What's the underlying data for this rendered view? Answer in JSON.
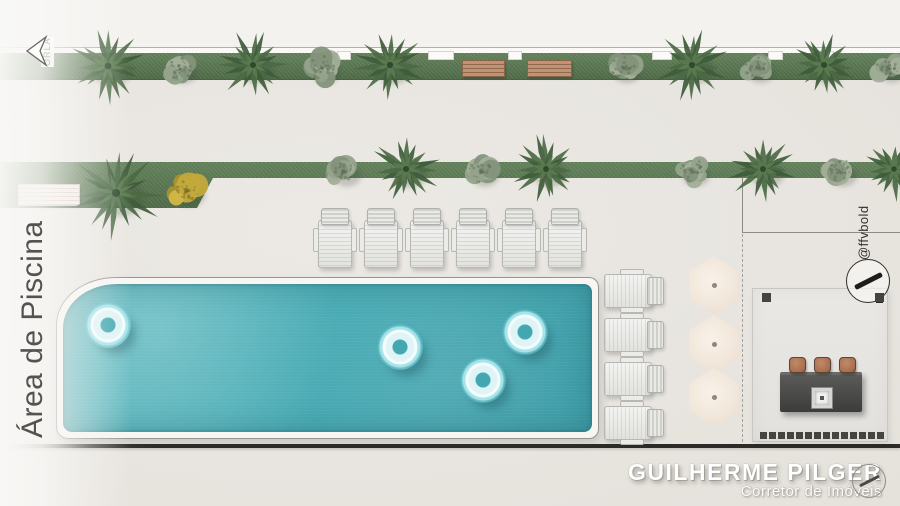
{
  "labels": {
    "area": "Área de Piscina",
    "orla": "ORLA",
    "handle": "@ffvbold",
    "brand_name": "GUILHERME PILGER",
    "brand_role": "Corretor de Imóveis"
  },
  "colors": {
    "grass": "#5e7f57",
    "water": "#49abb4",
    "coping": "#f7f6f3",
    "deck": "#e8e5e0",
    "wood_bench": "#bc8f6f",
    "dark_wall": "#2d2b28",
    "umbrella": "#f0e5d8",
    "counter": "#424240",
    "stool": "#b5795a"
  },
  "icons": {
    "orla_arrow": "left-arrow-icon",
    "logo": "slash-circle-icon"
  },
  "site": {
    "top_band": {
      "trees": [
        {
          "type": "palm",
          "x": 108,
          "y": 66,
          "s": 64
        },
        {
          "type": "bush",
          "x": 180,
          "y": 69,
          "s": 46
        },
        {
          "type": "palm",
          "x": 253,
          "y": 65,
          "s": 56
        },
        {
          "type": "bush",
          "x": 322,
          "y": 68,
          "s": 52
        },
        {
          "type": "palm",
          "x": 390,
          "y": 65,
          "s": 58
        },
        {
          "type": "bush",
          "x": 623,
          "y": 68,
          "s": 50
        },
        {
          "type": "palm",
          "x": 692,
          "y": 65,
          "s": 58
        },
        {
          "type": "bush",
          "x": 757,
          "y": 68,
          "s": 48
        },
        {
          "type": "palm",
          "x": 824,
          "y": 65,
          "s": 56
        },
        {
          "type": "bush",
          "x": 888,
          "y": 68,
          "s": 46
        }
      ],
      "benches": [
        {
          "x": 462,
          "y": 60,
          "w": 43
        },
        {
          "x": 527,
          "y": 60,
          "w": 45
        }
      ],
      "notches": [
        {
          "x": 337,
          "w": 14
        },
        {
          "x": 428,
          "w": 26
        },
        {
          "x": 508,
          "w": 14
        },
        {
          "x": 652,
          "w": 20
        },
        {
          "x": 768,
          "w": 15
        },
        {
          "x": 816,
          "w": 18
        }
      ]
    },
    "mid_band": {
      "trees": [
        {
          "type": "palm",
          "x": 116,
          "y": 193,
          "s": 80
        },
        {
          "type": "yellow",
          "x": 186,
          "y": 190,
          "s": 58
        },
        {
          "type": "bush",
          "x": 343,
          "y": 171,
          "s": 52
        },
        {
          "type": "palm",
          "x": 406,
          "y": 169,
          "s": 56
        },
        {
          "type": "bush",
          "x": 481,
          "y": 171,
          "s": 52
        },
        {
          "type": "palm",
          "x": 546,
          "y": 169,
          "s": 54
        },
        {
          "type": "bush",
          "x": 692,
          "y": 171,
          "s": 50
        },
        {
          "type": "palm",
          "x": 763,
          "y": 169,
          "s": 54
        },
        {
          "type": "bush",
          "x": 839,
          "y": 171,
          "s": 52
        },
        {
          "type": "palm",
          "x": 894,
          "y": 169,
          "s": 50
        }
      ]
    },
    "pool_floats": [
      {
        "cx": 108,
        "cy": 325
      },
      {
        "cx": 400,
        "cy": 347
      },
      {
        "cx": 483,
        "cy": 380
      },
      {
        "cx": 525,
        "cy": 332
      }
    ],
    "loungers_top": {
      "y": 208,
      "xs": [
        318,
        364,
        410,
        456,
        502,
        548
      ]
    },
    "loungers_right": {
      "x": 602,
      "ys": [
        274,
        318,
        362,
        406
      ]
    },
    "umbrellas": {
      "cx": 714,
      "cys": [
        285,
        344,
        397
      ]
    },
    "bbq_bottom_squares": {
      "x0": 760,
      "y": 432,
      "count": 14,
      "size": 7,
      "gap": 2
    },
    "bbq_corner_squares": [
      {
        "x": 762,
        "y": 293
      },
      {
        "x": 875,
        "y": 293
      }
    ]
  }
}
